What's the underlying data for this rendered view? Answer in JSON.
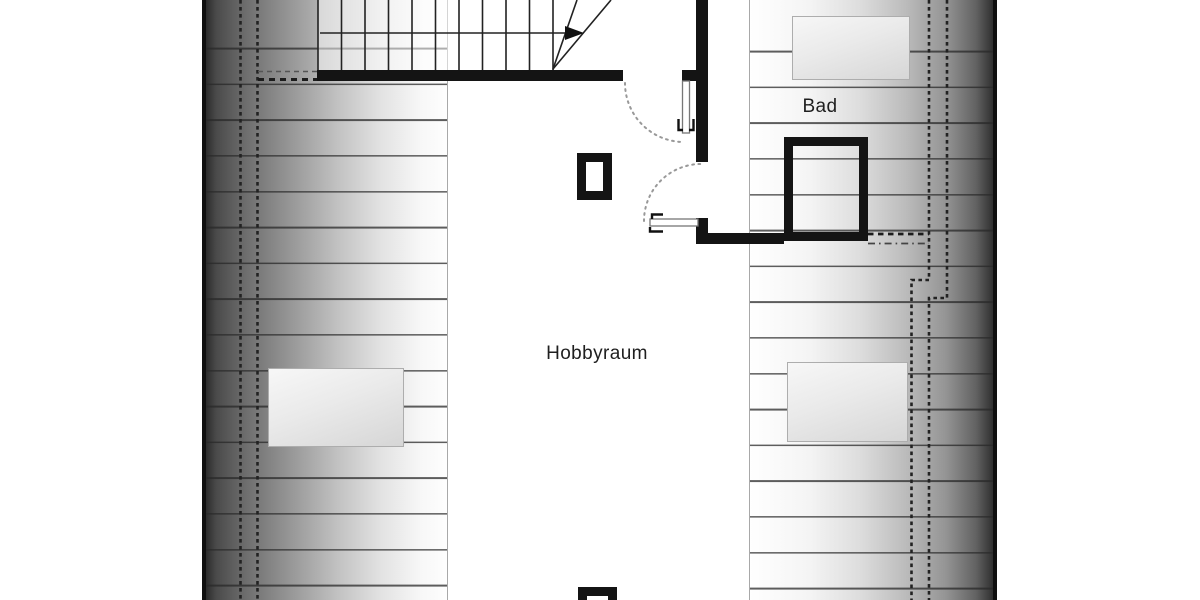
{
  "plan": {
    "type": "attic-floor-plan",
    "rooms": {
      "bad": {
        "label": "Bad"
      },
      "hobbyraum": {
        "label": "Hobbyraum"
      }
    },
    "symbols": {
      "staircase": "winder-staircase-with-up-direction-arrow",
      "doors": [
        "bath-entry-swing-door-top",
        "bath-swing-door-left"
      ],
      "shower": "shower-square-outline",
      "chimneys": 2,
      "roof_windows": 3,
      "roof_slope_hatching": "left-and-right-gradient-strips-with-horizontal-lines",
      "height_clearance_lines": "dashed-vertical-lines-with-jogs"
    },
    "colors": {
      "wall": "#141414",
      "hatch_line": "#282828",
      "dashed_line": "#222222",
      "door_arc": "#999999",
      "label_text": "#1f1f1f",
      "roof_edge": "#0f0f0f",
      "background": "#ffffff"
    }
  }
}
